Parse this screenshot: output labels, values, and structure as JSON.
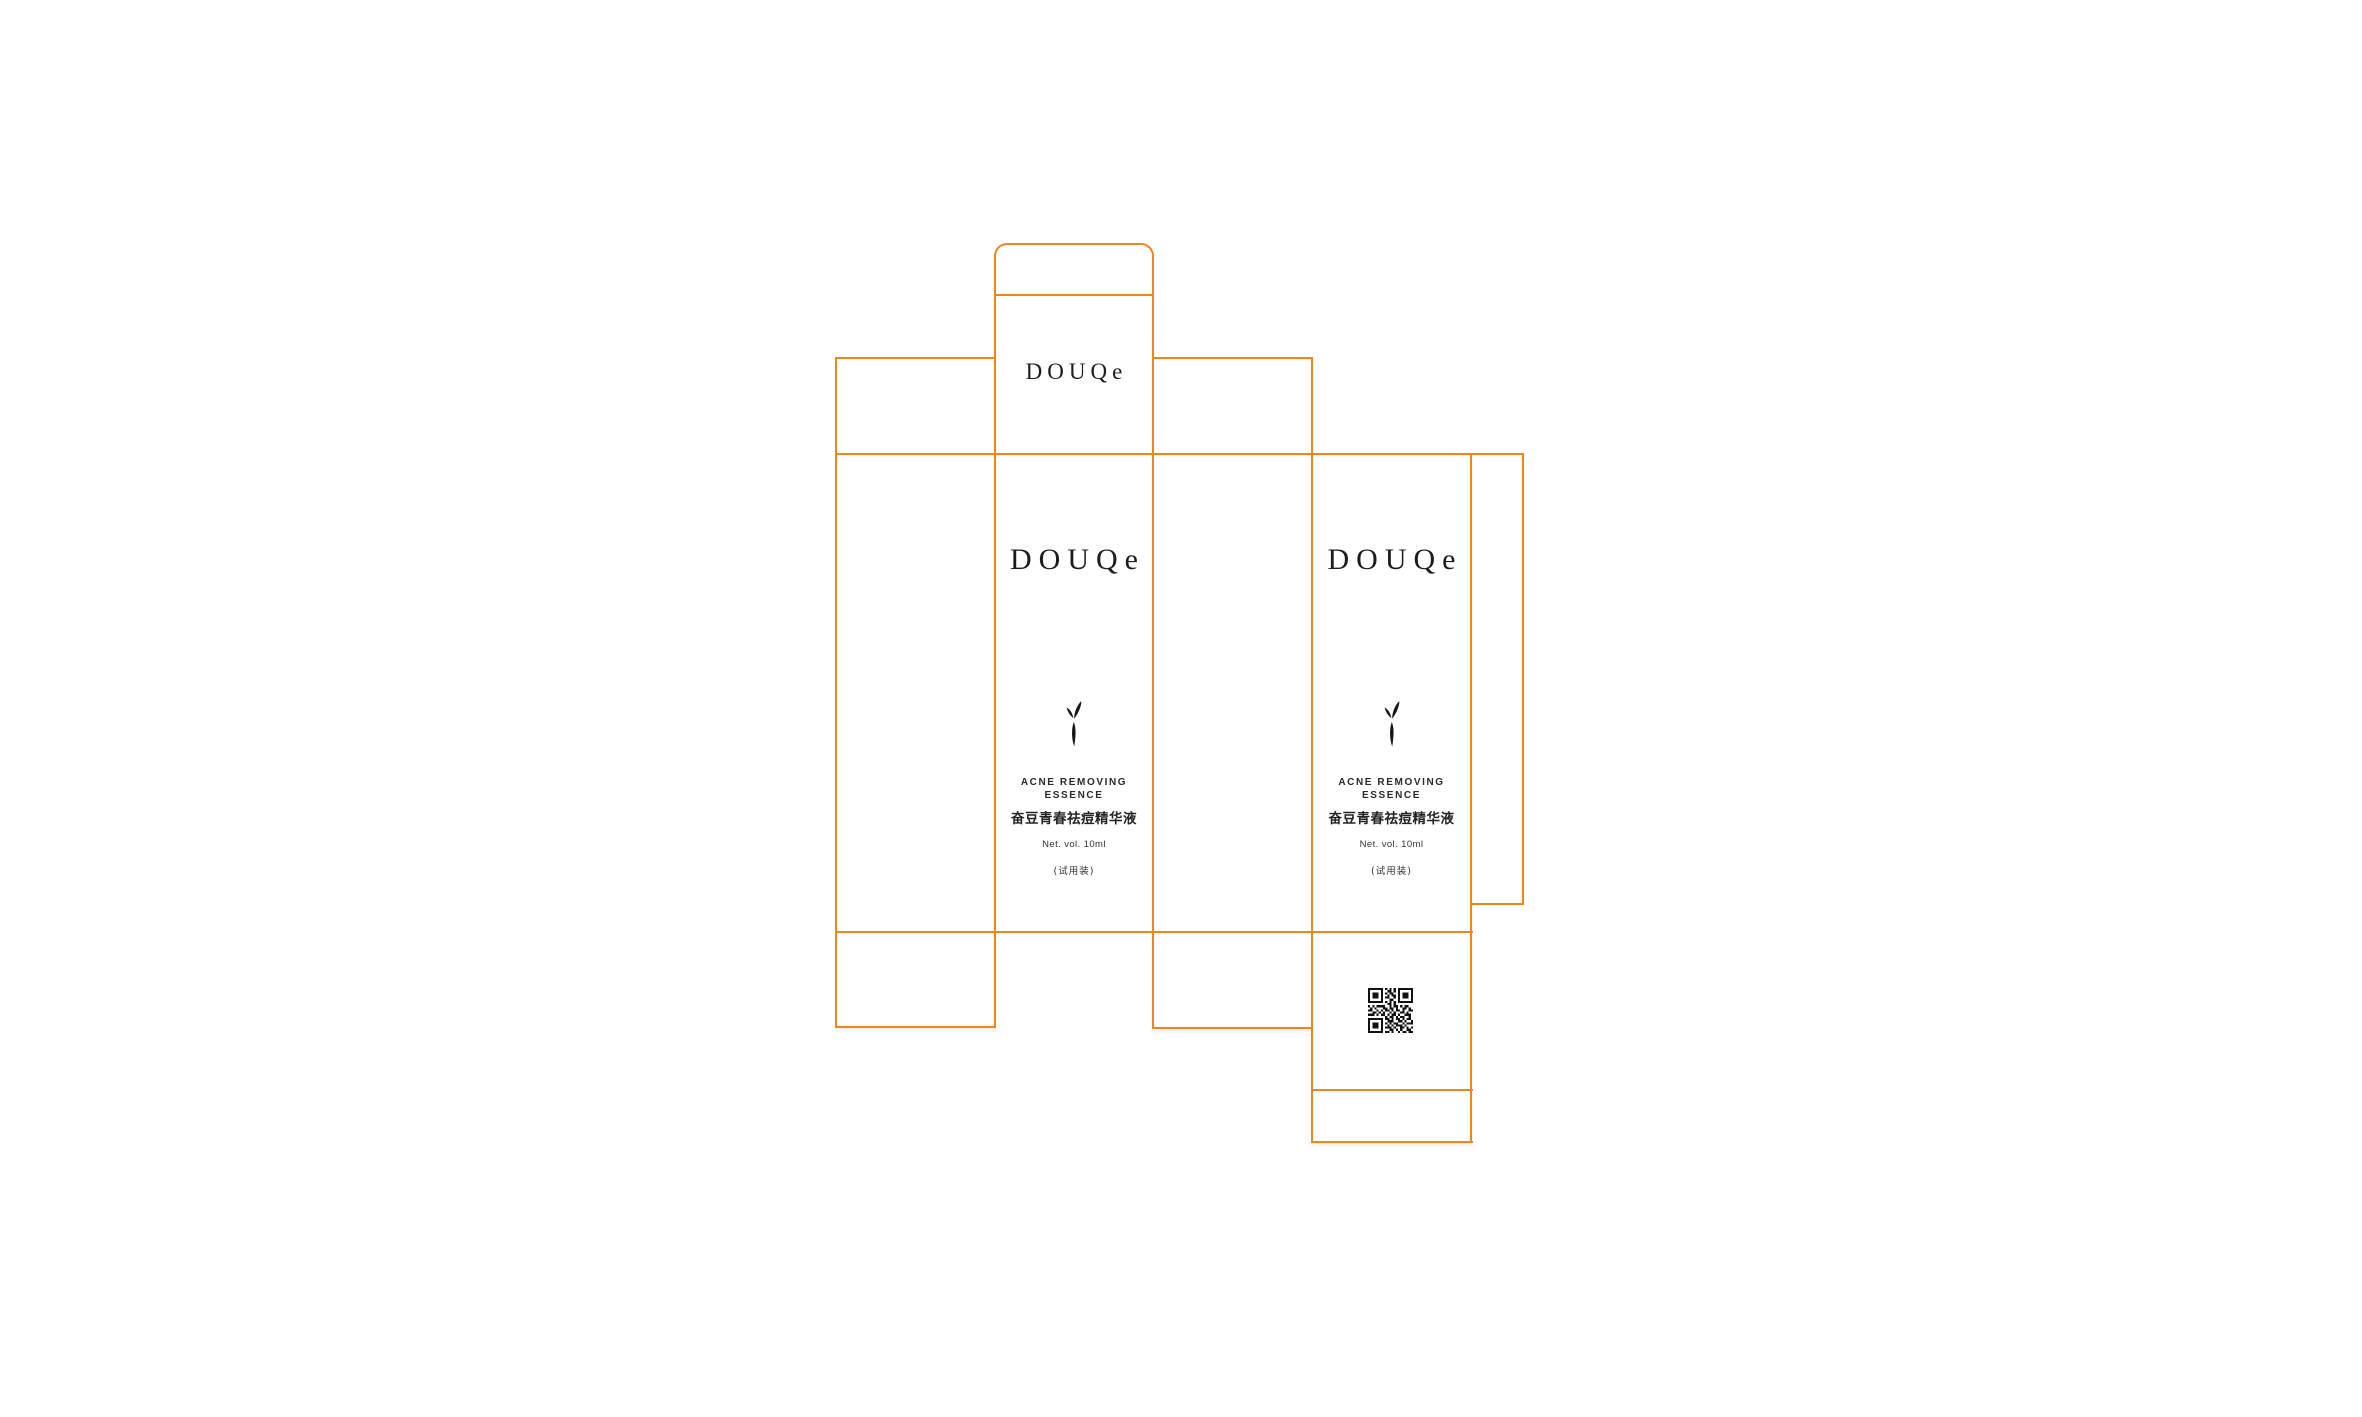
{
  "colors": {
    "dieline": "#ef861c",
    "ink": "#1d1d1b",
    "background": "#ffffff"
  },
  "brand": {
    "wordmark": "DOUQe"
  },
  "panel": {
    "tagline_line1": "ACNE REMOVING",
    "tagline_line2": "ESSENCE",
    "product_name_cn": "奋豆青春祛痘精华液",
    "net_volume": "Net. vol. 10ml",
    "trial_label": "(试用装)"
  },
  "icons": {
    "leaf": "leaf-sprig-icon",
    "qr": "qr-code-icon"
  }
}
